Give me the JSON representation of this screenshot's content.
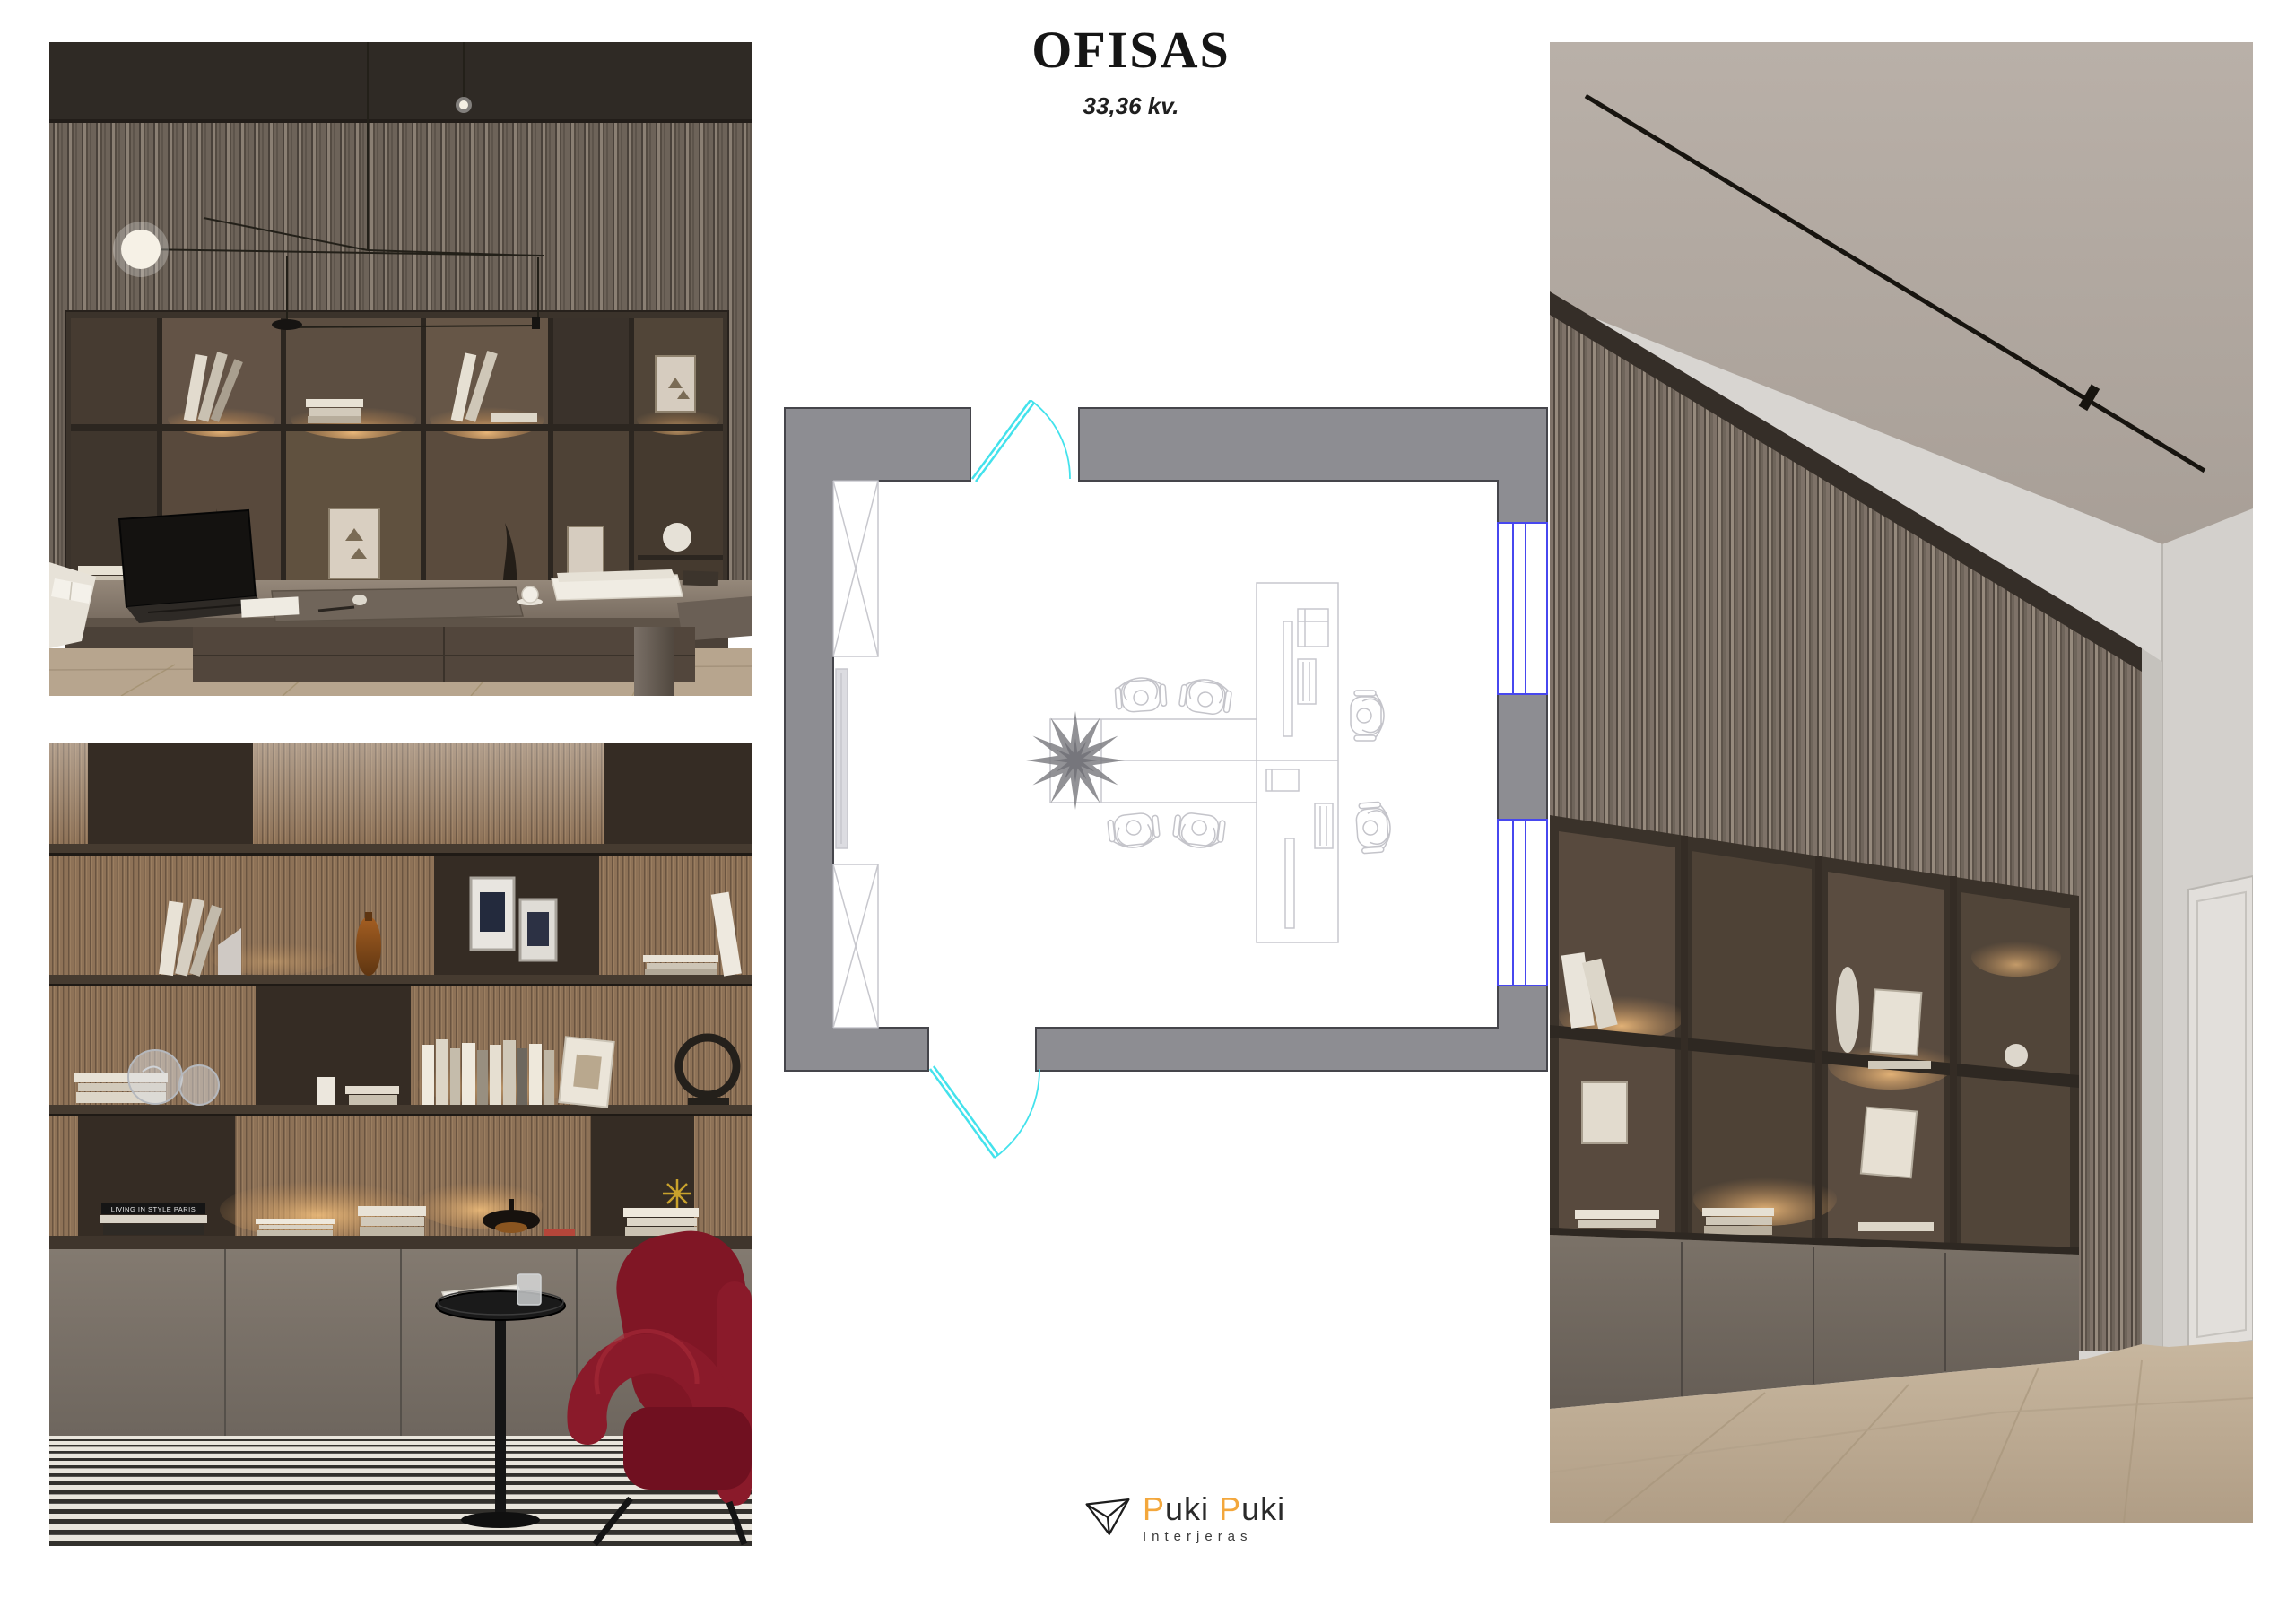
{
  "page": {
    "background": "#ffffff"
  },
  "header": {
    "title": "OFISAS",
    "subtitle": "33,36 kv."
  },
  "floor_plan": {
    "colors": {
      "wall_fill": "#8d8d92",
      "wall_stroke": "#45454b",
      "window": "#4747ef",
      "door_swing": "#43e2ec",
      "furniture": "#c7c7cd",
      "people": "#cfcfd4",
      "plant": "#7f7f84",
      "tv_fill": "#dcdce1"
    },
    "features": [
      "entrance-door-top",
      "entrance-door-bottom",
      "window-upper",
      "wall-pier",
      "window-lower",
      "wardrobe-upper",
      "tv-panel",
      "wardrobe-lower",
      "team-desk",
      "planter",
      "dual-workstation-desk",
      "office-chairs"
    ]
  },
  "photos": {
    "top_left": {
      "label": "office-desk-view"
    },
    "bottom_left": {
      "label": "shelf-lounge-view",
      "book_spine": "LIVING IN STYLE PARIS"
    },
    "right": {
      "label": "office-corner-view"
    }
  },
  "logo": {
    "mark": "triangle-mark",
    "word1_initial": "P",
    "word1_rest": "uki",
    "word2_initial": "P",
    "word2_rest": "uki",
    "tagline": "Interjeras",
    "accent": "#f3a73c",
    "ink": "#2a2a2a"
  }
}
